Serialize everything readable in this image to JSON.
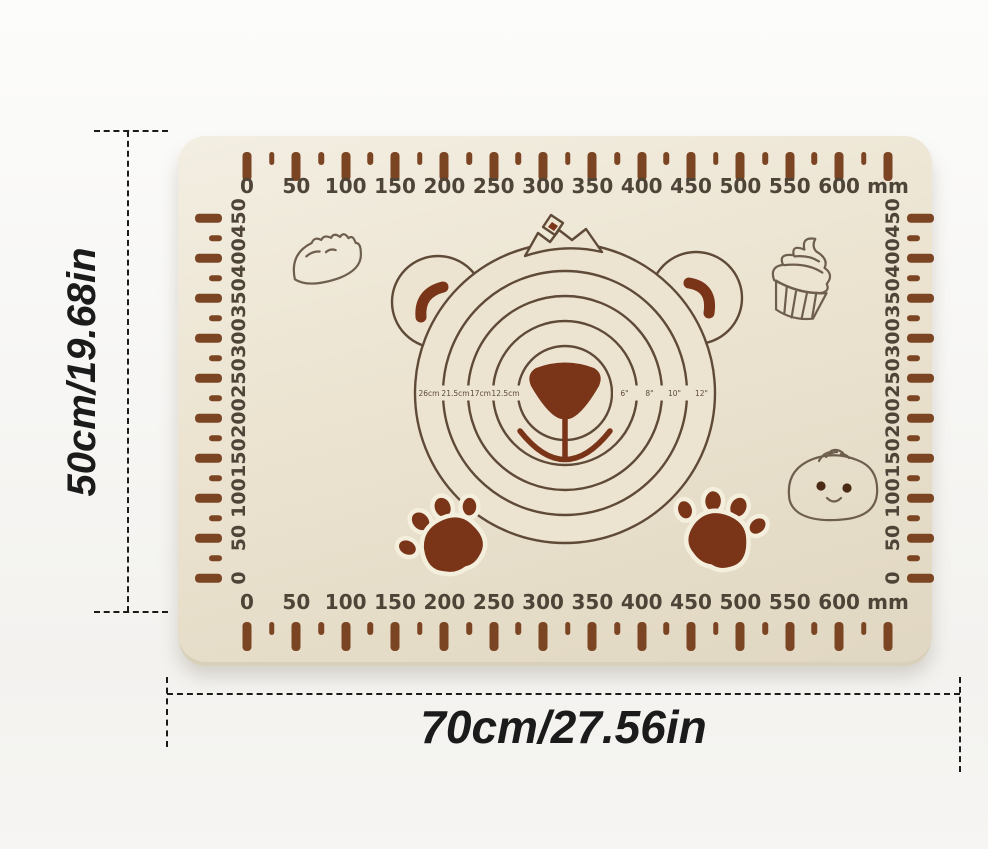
{
  "product": {
    "type_label": "silicone pastry baking mat with measurements"
  },
  "mat": {
    "unit_label": "mm",
    "horizontal_labels": [
      "0",
      "50",
      "100",
      "150",
      "200",
      "250",
      "300",
      "350",
      "400",
      "450",
      "500",
      "550",
      "600"
    ],
    "vertical_labels": [
      "450",
      "400",
      "350",
      "300",
      "250",
      "200",
      "150",
      "100",
      "50",
      "0"
    ],
    "circle_labels_left": [
      "26cm",
      "21.5cm",
      "17cm",
      "12.5cm"
    ],
    "circle_labels_right": [
      "6\"",
      "8\"",
      "10\"",
      "12\""
    ]
  },
  "dimensions": {
    "height_label": "50cm/19.68in",
    "width_label": "70cm/27.56in"
  },
  "decorations": [
    "bear-face",
    "crown",
    "dumpling",
    "cupcake",
    "steamed-bun",
    "paw-print-left",
    "paw-print-right"
  ],
  "colors": {
    "background": "#f7f6f4",
    "mat": "#ece4d1",
    "mat_edge": "#d9d0ba",
    "tick": "#7b4523",
    "number": "#4e4437",
    "line": "#5e4a37",
    "art": "#6e5e4d",
    "art_dark": "#4a2a14",
    "dark_fill": "#7a3418",
    "dimension": "#1b1b1b"
  }
}
